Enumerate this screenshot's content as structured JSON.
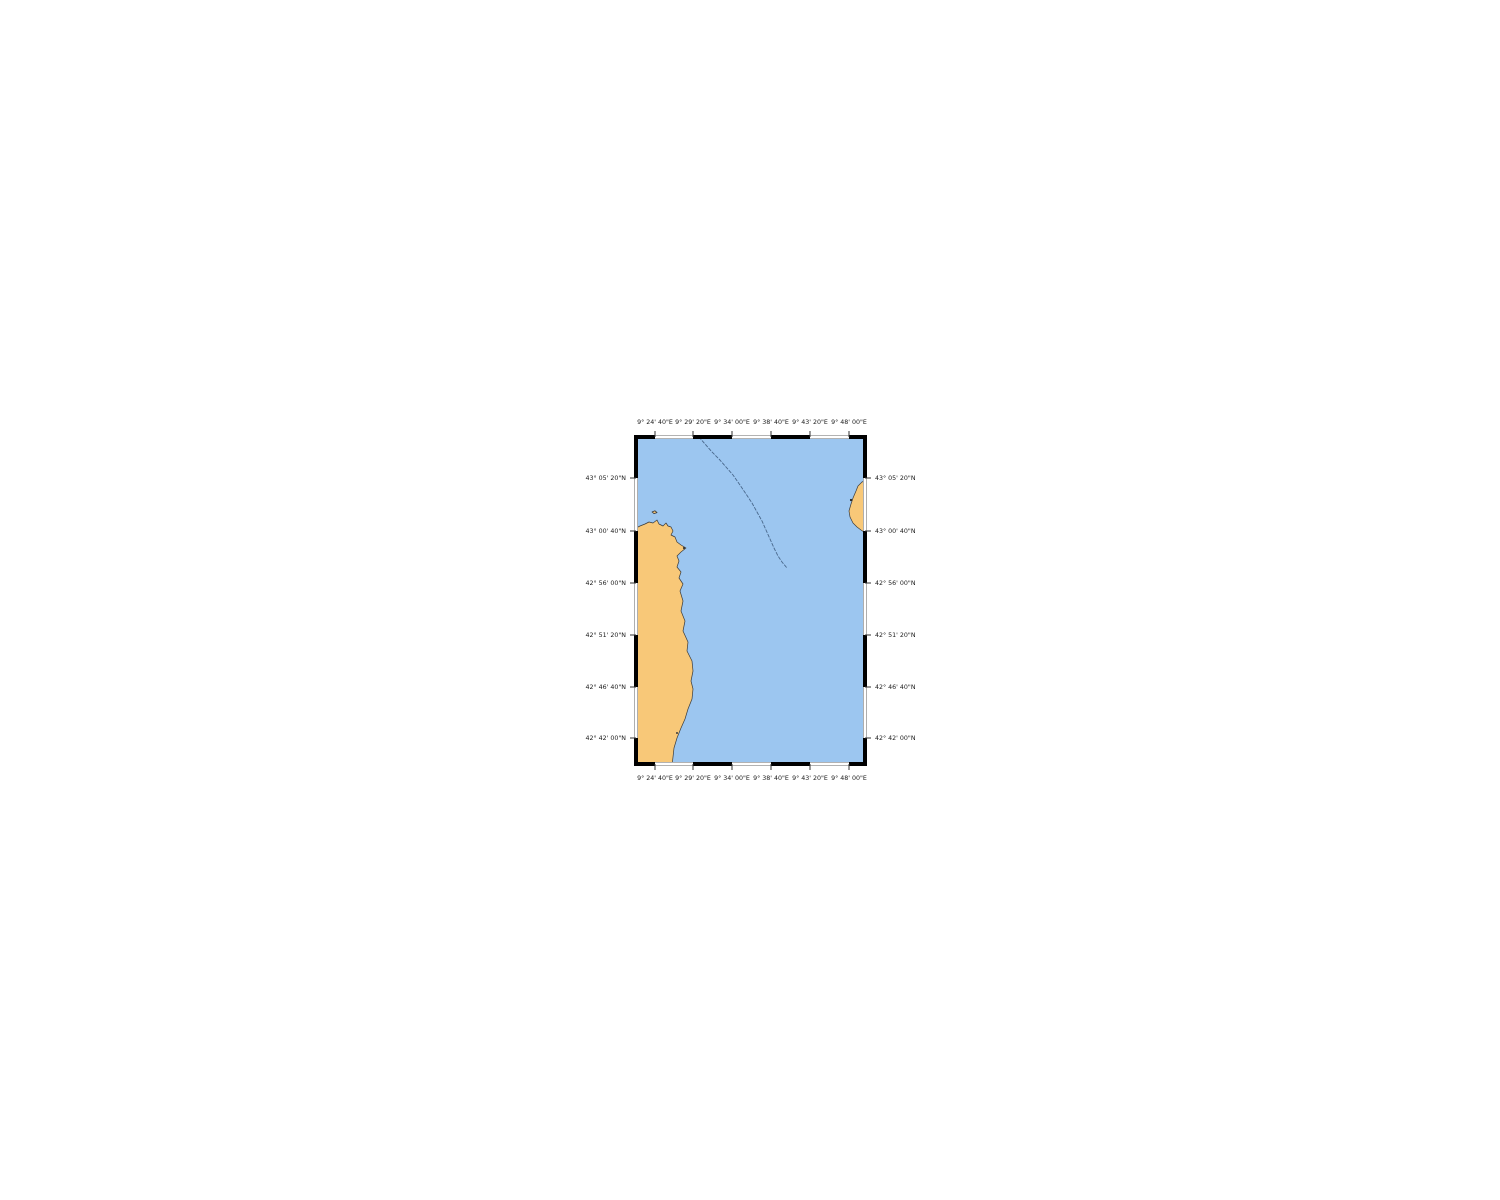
{
  "map": {
    "description_name": "coastal-nautical-chart",
    "frame": {
      "left": 636,
      "top": 437,
      "right": 865,
      "bottom": 764,
      "width": 229,
      "height": 327
    },
    "colors": {
      "sea": "#9cc6f0",
      "land": "#f8c878",
      "coast_outline": "#3a3a3a",
      "contour_line": "#49688c",
      "frame_black": "#000000",
      "frame_white": "#ffffff",
      "frame_gray": "#999999",
      "tick": "#333333",
      "label_text": "#1a1a1a",
      "background": "#ffffff"
    },
    "axis_labels": {
      "top": [
        "9° 24' 40\"E",
        "9° 29' 20\"E",
        "9° 34' 00\"E",
        "9° 38' 40\"E",
        "9° 43' 20\"E",
        "9° 48' 00\"E"
      ],
      "bottom": [
        "9° 24' 40\"E",
        "9° 29' 20\"E",
        "9° 34' 00\"E",
        "9° 38' 40\"E",
        "9° 43' 20\"E",
        "9° 48' 00\"E"
      ],
      "left": [
        "43° 05' 20\"N",
        "43° 00' 40\"N",
        "42° 56' 00\"N",
        "42° 51' 20\"N",
        "42° 46' 40\"N",
        "42° 42' 00\"N"
      ],
      "right": [
        "43° 05' 20\"N",
        "43° 00' 40\"N",
        "42° 56' 00\"N",
        "42° 51' 20\"N",
        "42° 46' 40\"N",
        "42° 42' 00\"N"
      ]
    },
    "graticule": {
      "lon_tick_x": [
        655,
        693,
        732,
        771,
        810,
        849
      ],
      "lat_tick_y": [
        478,
        531,
        583,
        635,
        687,
        738
      ],
      "lon_step": "4' 40\"",
      "lat_step": "4' 40\""
    },
    "paths": {
      "mainland": "M 636 528 L 640 526 L 645 524 L 649 522 L 653 523 L 657 520 L 659 524 L 663 526 L 666 523 L 668 526 L 671 527 L 673 531 L 671 535 L 675 537 L 677 542 L 681 545 L 686 548 L 681 552 L 677 556 L 679 561 L 677 567 L 681 572 L 679 578 L 683 584 L 680 591 L 683 601 L 681 611 L 685 621 L 683 631 L 688 642 L 687 651 L 692 661 L 693 671 L 691 681 L 693 689 L 692 699 L 688 709 L 685 719 L 681 728 L 677 738 L 674 748 L 673 757 L 672 766 L 634 766 Z",
      "island_ne": "M 867 480 L 862 482 L 858 486 L 856 491 L 853 498 L 851 504 L 849 511 L 850 517 L 853 523 L 857 527 L 861 530 L 864 532 L 867 534 Z",
      "islet_nw": "M 652 512 L 655 510.8 L 657 512.6 L 654 513.6 Z",
      "contour_line": "M 699 437 L 705 444 L 712 452 L 719 459 L 726 467 L 733 475 L 740 485 L 746 494 L 752 503 L 757 512 L 762 521 L 766 530 L 770 539 L 774 548 L 778 556 L 782 562 L 787 568"
    },
    "point_features": {
      "islet_off_cape": {
        "x": 684,
        "y": 548
      },
      "rock_on_coast": {
        "x": 677,
        "y": 733
      },
      "mark_on_island": {
        "x": 851,
        "y": 500
      }
    }
  }
}
